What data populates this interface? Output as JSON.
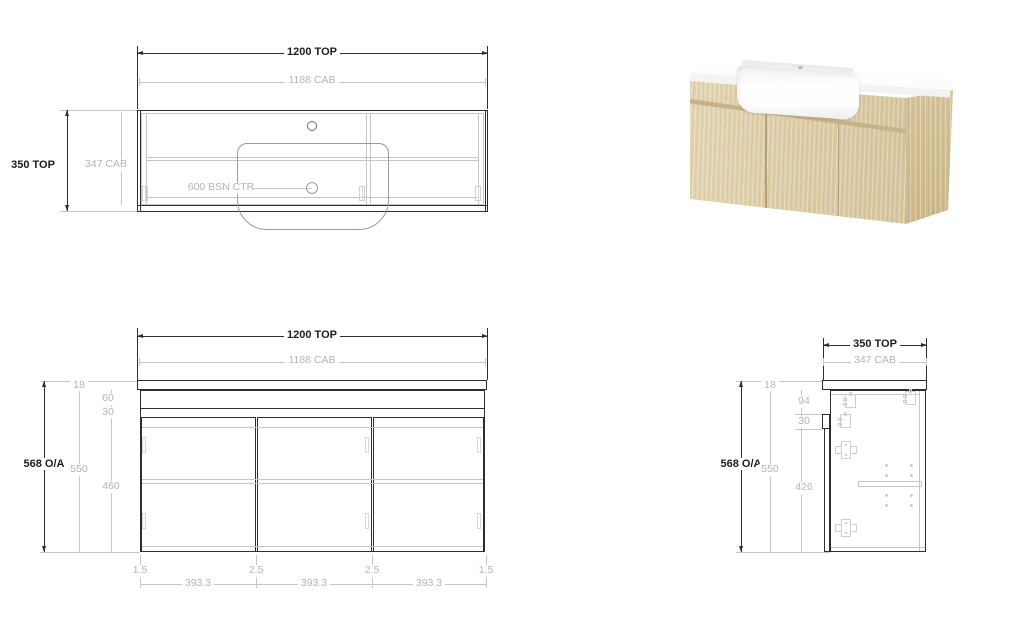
{
  "drawing": {
    "plan": {
      "width_top": "1200 TOP",
      "width_cab": "1188 CAB",
      "depth_top": "350 TOP",
      "depth_cab": "347 CAB",
      "basin_center": "600 BSN CTR"
    },
    "front": {
      "width_top": "1200 TOP",
      "width_cab": "1188 CAB",
      "height_overall": "568 O/A",
      "height_cab": "550",
      "door_height": "460",
      "top_thickness": "18",
      "void_height": "60",
      "reveal": "30",
      "bottom_row": [
        "1.5",
        "393.3",
        "2.5",
        "393.3",
        "2.5",
        "393.3",
        "1.5"
      ]
    },
    "side": {
      "depth_top": "350 TOP",
      "depth_cab": "347 CAB",
      "height_overall": "568 O/A",
      "height_cab": "550",
      "door_height": "426",
      "top_thickness": "18",
      "hinge_offset": "94",
      "lip_height": "30"
    }
  },
  "colors": {
    "line_dark": "#2e2e2e",
    "line_gray": "#c6c6c6",
    "text_dark": "#1d1d1d",
    "text_gray": "#b4b4b4",
    "wood_front": "#dbcba6",
    "wood_side": "#d2bf97",
    "counter_white": "#fafafa",
    "basin_white": "#ffffff"
  }
}
